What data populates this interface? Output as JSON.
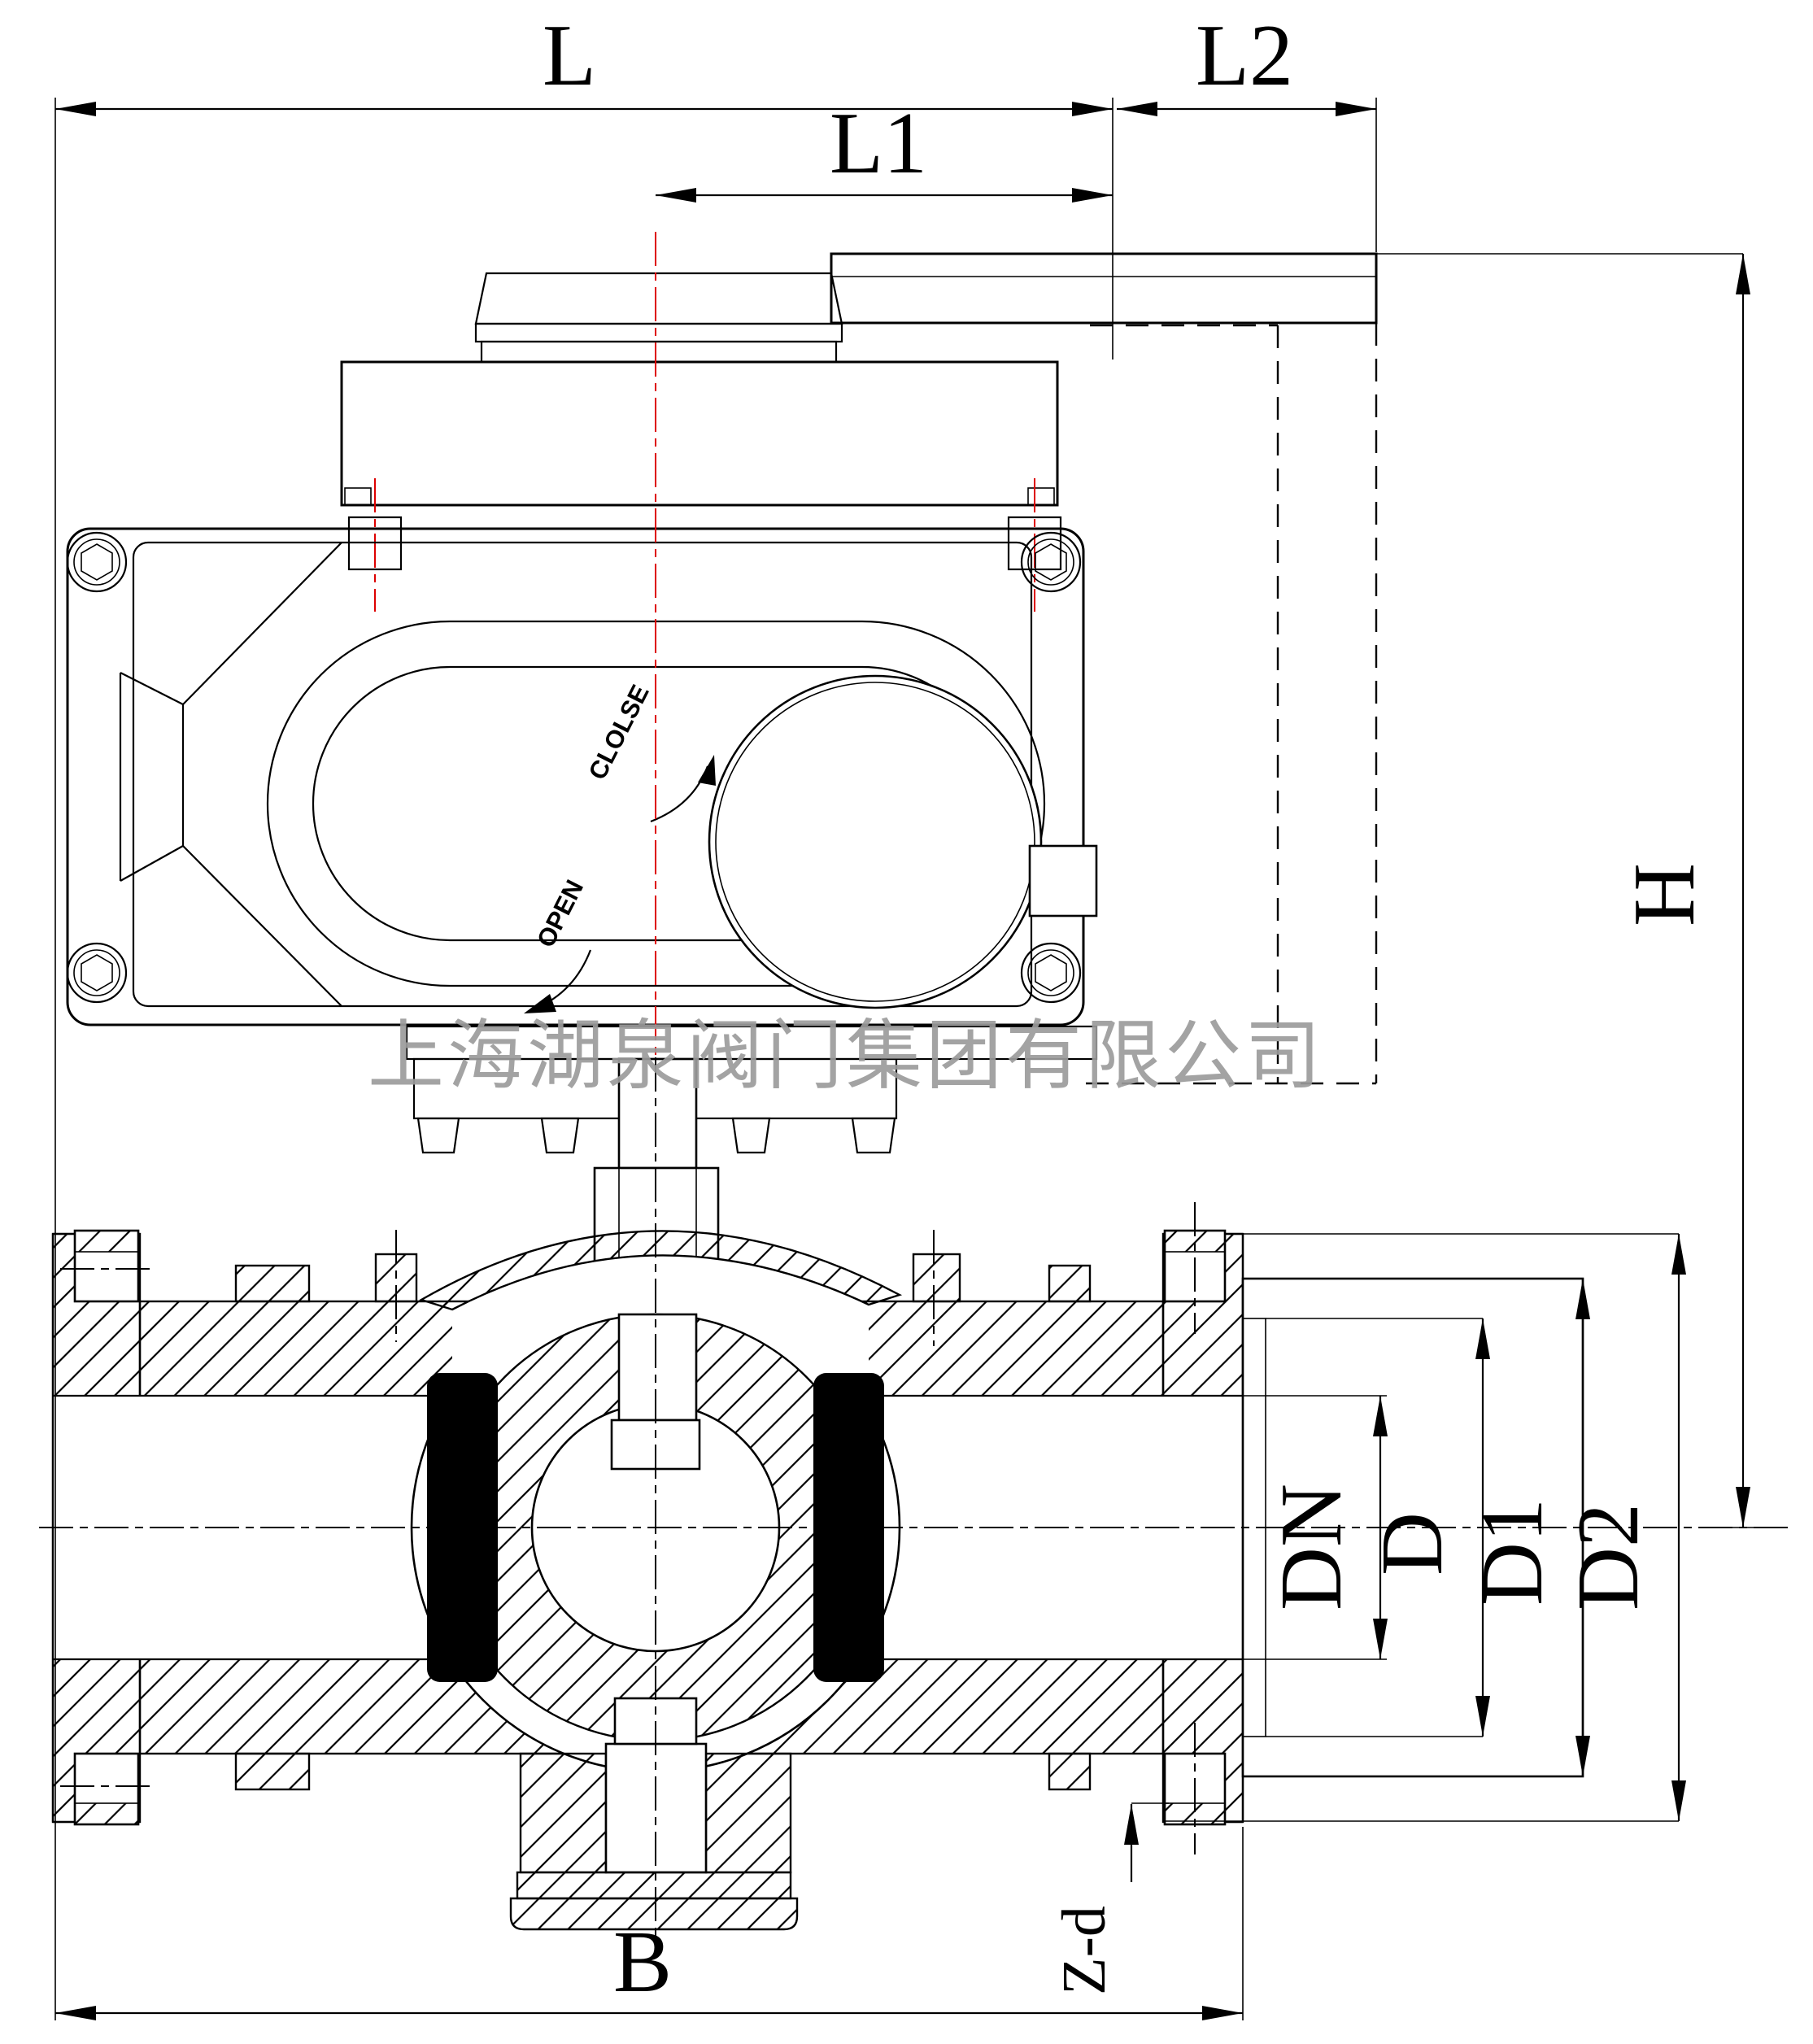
{
  "drawing": {
    "type": "technical-drawing",
    "subject": "electric-actuator three-way ball valve cross-section",
    "watermark": "上海湖泉阀门集团有限公司",
    "colors": {
      "line": "#000000",
      "centerline_red": "#dd0000",
      "watermark_gray": "#9c9c9c",
      "background": "#ffffff"
    },
    "dimension_labels": {
      "L": "L",
      "L1": "L1",
      "L2": "L2",
      "H": "H",
      "DN": "DN",
      "D": "D",
      "D1": "D1",
      "D2": "D2",
      "B": "B",
      "Z_d": "Z-d"
    },
    "actuator_markings": {
      "close": "CLOLSE",
      "open": "OPEN"
    }
  }
}
